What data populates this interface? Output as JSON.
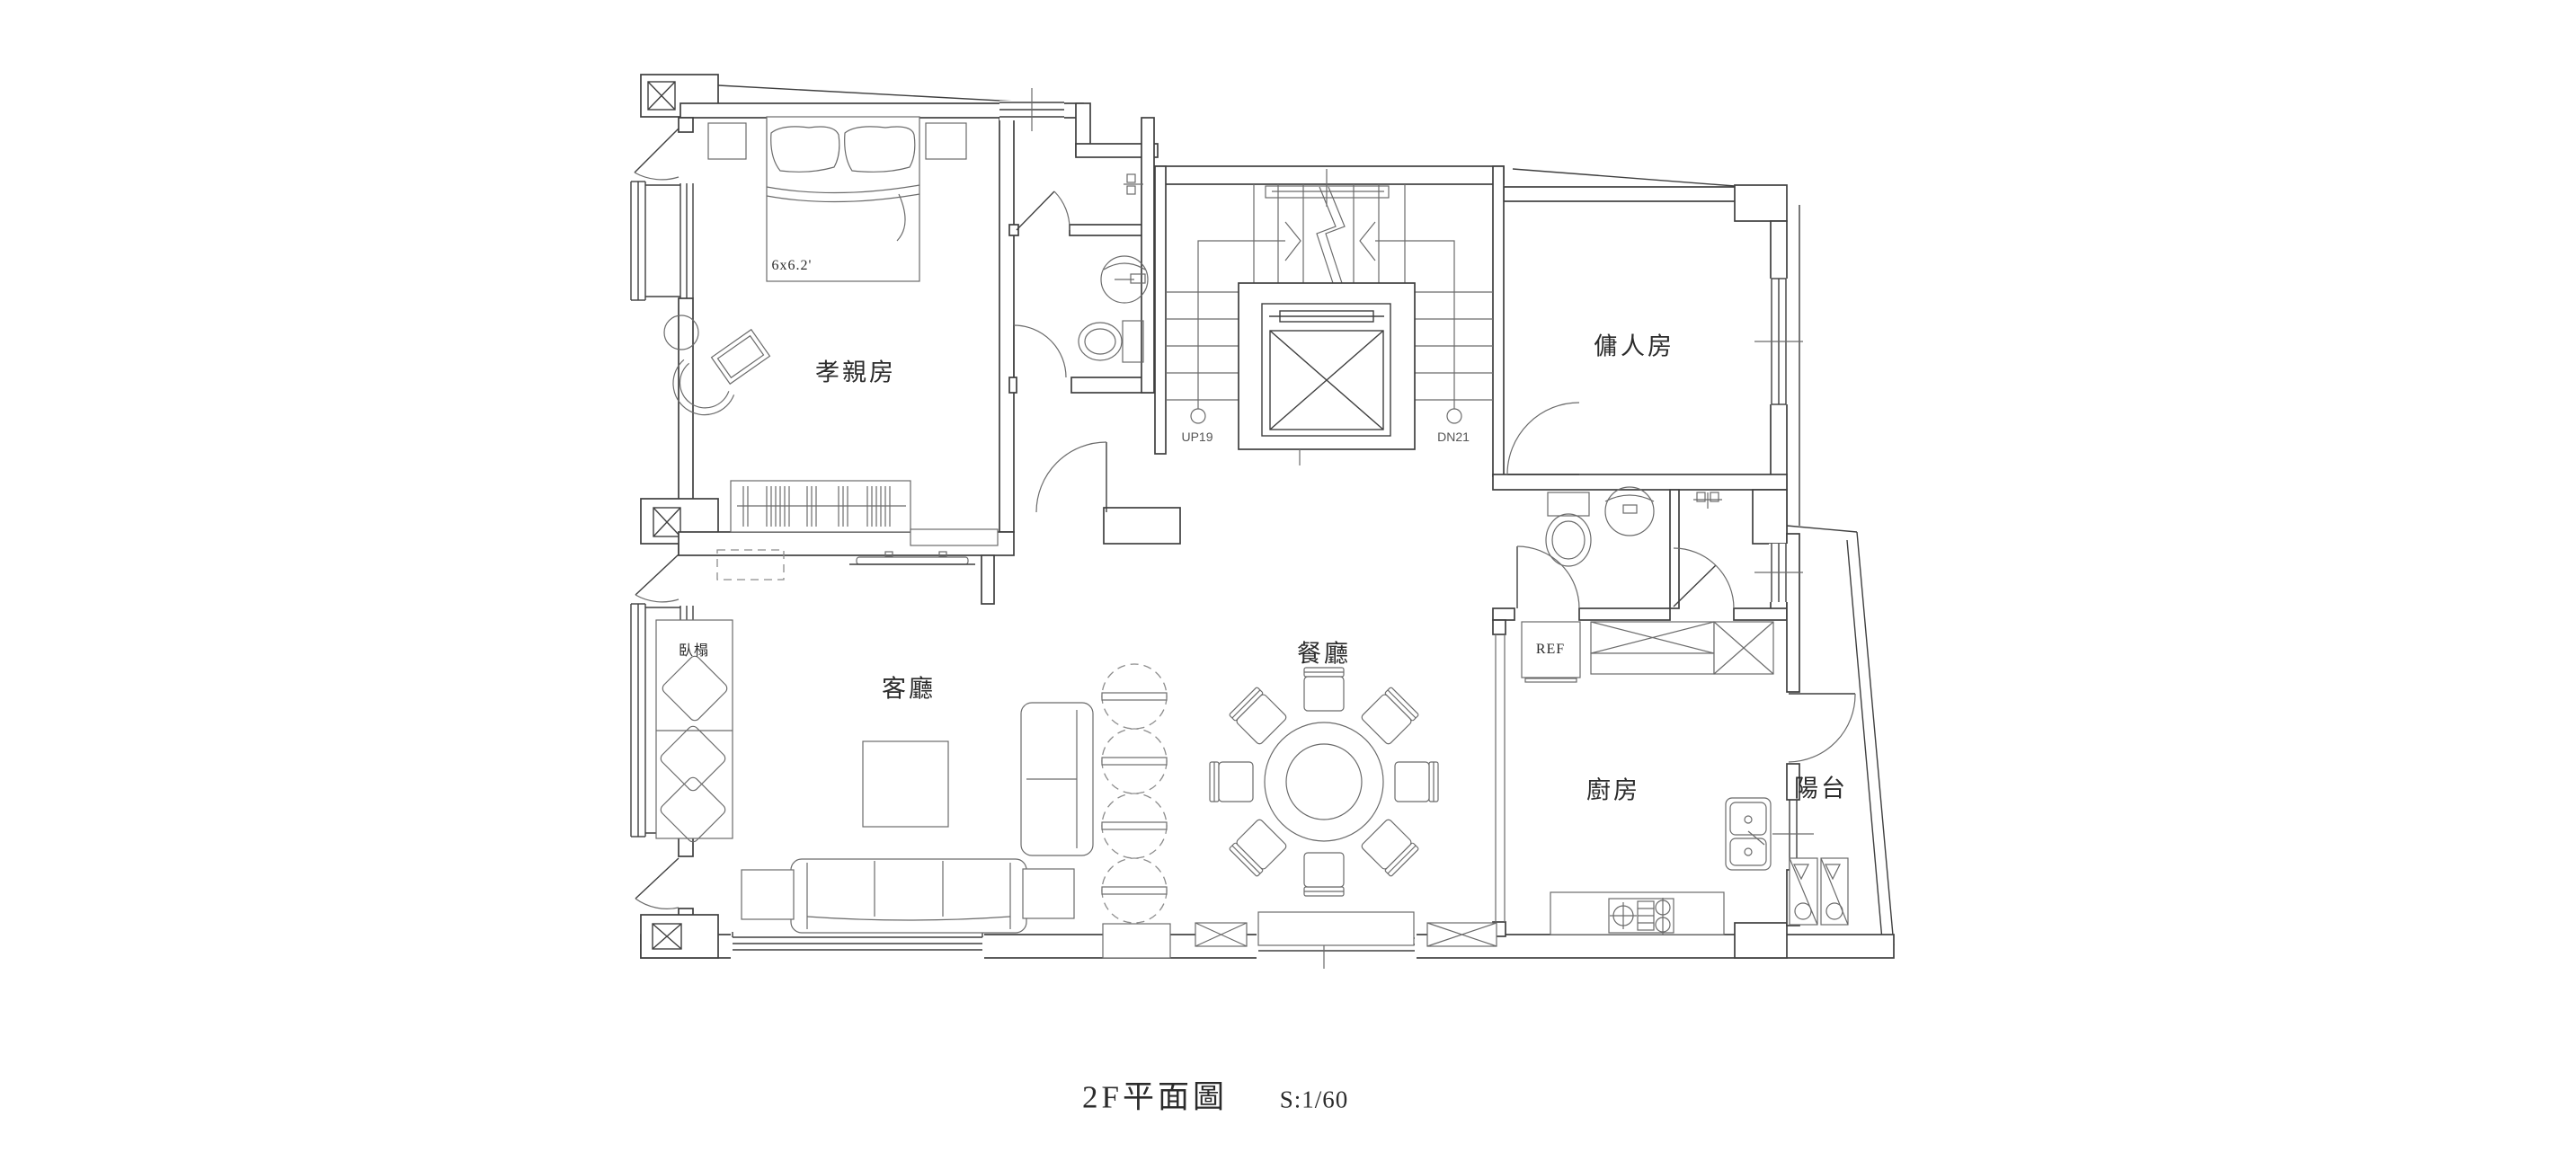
{
  "title": {
    "name": "2F平面圖",
    "scale": "S:1/60"
  },
  "rooms": {
    "parents_room": "孝親房",
    "servant_room": "傭人房",
    "living_room": "客廳",
    "dining_room": "餐廳",
    "kitchen": "廚房",
    "balcony": "陽台"
  },
  "annotations": {
    "daybed": "臥榻",
    "bed_size": "6x6.2'",
    "stairs_up": "UP19",
    "stairs_down": "DN21",
    "refrigerator": "REF"
  },
  "colors": {
    "wall_line": "#3f3f3f",
    "furniture_line": "#6b6b6b",
    "background": "#ffffff"
  }
}
